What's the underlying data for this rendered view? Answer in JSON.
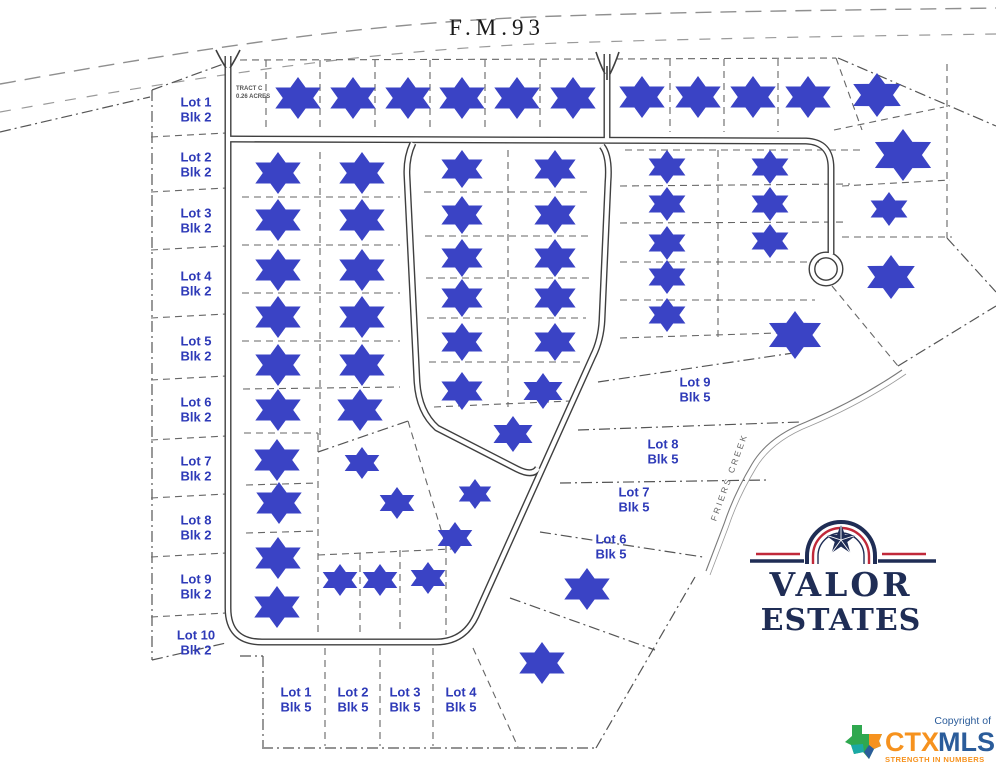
{
  "map": {
    "highway_label": "F.M.93",
    "tract_line1": "TRACT C",
    "tract_line2": "0.26 ACRES",
    "creek_label": "FRIERS CREEK",
    "marker_color": "#3a43c5",
    "label_color": "#2e3ab8",
    "block2_lots": [
      {
        "lot": "Lot 1",
        "blk": "Blk 2",
        "x": 196,
        "y": 110
      },
      {
        "lot": "Lot 2",
        "blk": "Blk 2",
        "x": 196,
        "y": 165
      },
      {
        "lot": "Lot 3",
        "blk": "Blk 2",
        "x": 196,
        "y": 221
      },
      {
        "lot": "Lot 4",
        "blk": "Blk 2",
        "x": 196,
        "y": 284
      },
      {
        "lot": "Lot 5",
        "blk": "Blk 2",
        "x": 196,
        "y": 349
      },
      {
        "lot": "Lot 6",
        "blk": "Blk 2",
        "x": 196,
        "y": 410
      },
      {
        "lot": "Lot 7",
        "blk": "Blk 2",
        "x": 196,
        "y": 469
      },
      {
        "lot": "Lot 8",
        "blk": "Blk 2",
        "x": 196,
        "y": 528
      },
      {
        "lot": "Lot 9",
        "blk": "Blk 2",
        "x": 196,
        "y": 587
      },
      {
        "lot": "Lot 10",
        "blk": "Blk 2",
        "x": 196,
        "y": 643
      }
    ],
    "block5_right_lots": [
      {
        "lot": "Lot 9",
        "blk": "Blk 5",
        "x": 695,
        "y": 390
      },
      {
        "lot": "Lot 8",
        "blk": "Blk 5",
        "x": 663,
        "y": 452
      },
      {
        "lot": "Lot 7",
        "blk": "Blk 5",
        "x": 634,
        "y": 500
      },
      {
        "lot": "Lot 6",
        "blk": "Blk 5",
        "x": 611,
        "y": 547
      }
    ],
    "block5_bottom_lots": [
      {
        "lot": "Lot 1",
        "blk": "Blk 5",
        "x": 296,
        "y": 700
      },
      {
        "lot": "Lot 2",
        "blk": "Blk 5",
        "x": 353,
        "y": 700
      },
      {
        "lot": "Lot 3",
        "blk": "Blk 5",
        "x": 405,
        "y": 700
      },
      {
        "lot": "Lot 4",
        "blk": "Blk 5",
        "x": 461,
        "y": 700
      }
    ],
    "markers": [
      [
        298,
        98,
        21
      ],
      [
        353,
        98,
        21
      ],
      [
        408,
        98,
        21
      ],
      [
        462,
        98,
        21
      ],
      [
        517,
        98,
        21
      ],
      [
        573,
        98,
        21
      ],
      [
        642,
        97,
        21
      ],
      [
        698,
        97,
        21
      ],
      [
        753,
        97,
        21
      ],
      [
        808,
        97,
        21
      ],
      [
        877,
        95,
        22
      ],
      [
        903,
        155,
        26
      ],
      [
        889,
        209,
        17
      ],
      [
        891,
        277,
        22
      ],
      [
        278,
        173,
        21
      ],
      [
        278,
        220,
        21
      ],
      [
        278,
        270,
        21
      ],
      [
        278,
        317,
        21
      ],
      [
        278,
        365,
        21
      ],
      [
        278,
        410,
        21
      ],
      [
        277,
        460,
        21
      ],
      [
        279,
        503,
        21
      ],
      [
        278,
        558,
        21
      ],
      [
        277,
        607,
        21
      ],
      [
        362,
        173,
        21
      ],
      [
        362,
        220,
        21
      ],
      [
        362,
        270,
        21
      ],
      [
        362,
        317,
        21
      ],
      [
        362,
        365,
        21
      ],
      [
        360,
        410,
        21
      ],
      [
        462,
        169,
        19
      ],
      [
        462,
        215,
        19
      ],
      [
        462,
        258,
        19
      ],
      [
        462,
        298,
        19
      ],
      [
        462,
        342,
        19
      ],
      [
        462,
        391,
        19
      ],
      [
        555,
        169,
        19
      ],
      [
        555,
        215,
        19
      ],
      [
        555,
        258,
        19
      ],
      [
        555,
        298,
        19
      ],
      [
        555,
        342,
        19
      ],
      [
        543,
        391,
        18
      ],
      [
        513,
        434,
        18
      ],
      [
        362,
        463,
        16
      ],
      [
        397,
        503,
        16
      ],
      [
        475,
        494,
        15
      ],
      [
        455,
        538,
        16
      ],
      [
        340,
        580,
        16
      ],
      [
        380,
        580,
        16
      ],
      [
        428,
        578,
        16
      ],
      [
        667,
        167,
        17
      ],
      [
        667,
        204,
        17
      ],
      [
        667,
        243,
        17
      ],
      [
        667,
        277,
        17
      ],
      [
        667,
        315,
        17
      ],
      [
        770,
        167,
        17
      ],
      [
        770,
        204,
        17
      ],
      [
        770,
        241,
        17
      ],
      [
        795,
        335,
        24
      ],
      [
        587,
        589,
        21
      ],
      [
        542,
        663,
        21
      ]
    ]
  },
  "branding": {
    "valor_line1": "VALOR",
    "valor_line2": "ESTATES",
    "navy": "#1f2d55",
    "red": "#c0293a"
  },
  "ctxmls": {
    "copyright": "Copyright of",
    "brand_part1": "CTX",
    "brand_part2": "MLS",
    "tagline": "STRENGTH IN NUMBERS",
    "orange": "#f6921e",
    "blue": "#2b5c9a"
  }
}
